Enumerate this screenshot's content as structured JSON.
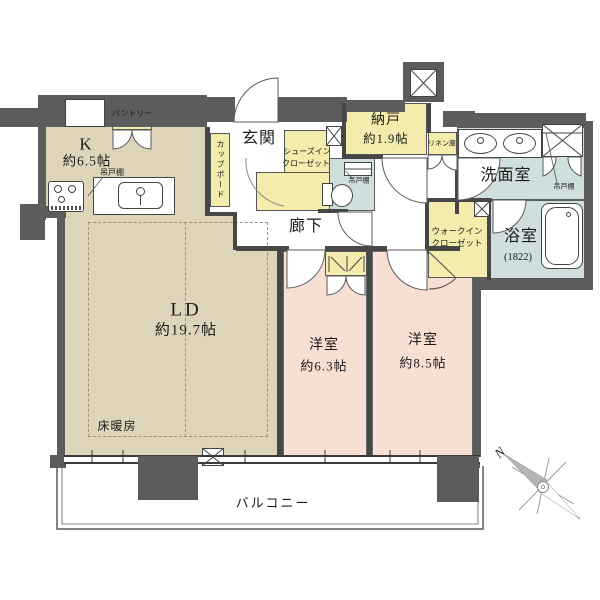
{
  "title": "apartment-floor-plan",
  "colors": {
    "wall": "#5c5c5c",
    "living_floor": "#ddd4ba",
    "bedroom_floor": "#f8dfd3",
    "storage_floor": "#f3ecac",
    "wet_area_floor": "#cfdfdd"
  },
  "labels": {
    "k_name": "K",
    "k_area": "約6.5帖",
    "pantry": "パントリー",
    "kitchen_cabinet": "吊戸棚",
    "cupboard": "カップボード",
    "genkan": "玄関",
    "sic_line1": "シューズイン",
    "sic_line2": "クローゼット",
    "nando_name": "納戸",
    "nando_area": "約1.9帖",
    "toilet_cabinet": "吊戸棚",
    "linen": "リネン庫",
    "washroom": "洗面室",
    "washroom_cabinet": "吊戸棚",
    "corridor": "廊下",
    "wic_line1": "ウォークイン",
    "wic_line2": "クローゼット",
    "bath": "浴室",
    "bath_size": "(1822)",
    "ld_name": "LD",
    "ld_area": "約19.7帖",
    "floor_heating": "床暖房",
    "bed1_name": "洋室",
    "bed1_area": "約6.3帖",
    "bed2_name": "洋室",
    "bed2_area": "約8.5帖",
    "balcony": "バルコニー",
    "compass_north": "N"
  }
}
